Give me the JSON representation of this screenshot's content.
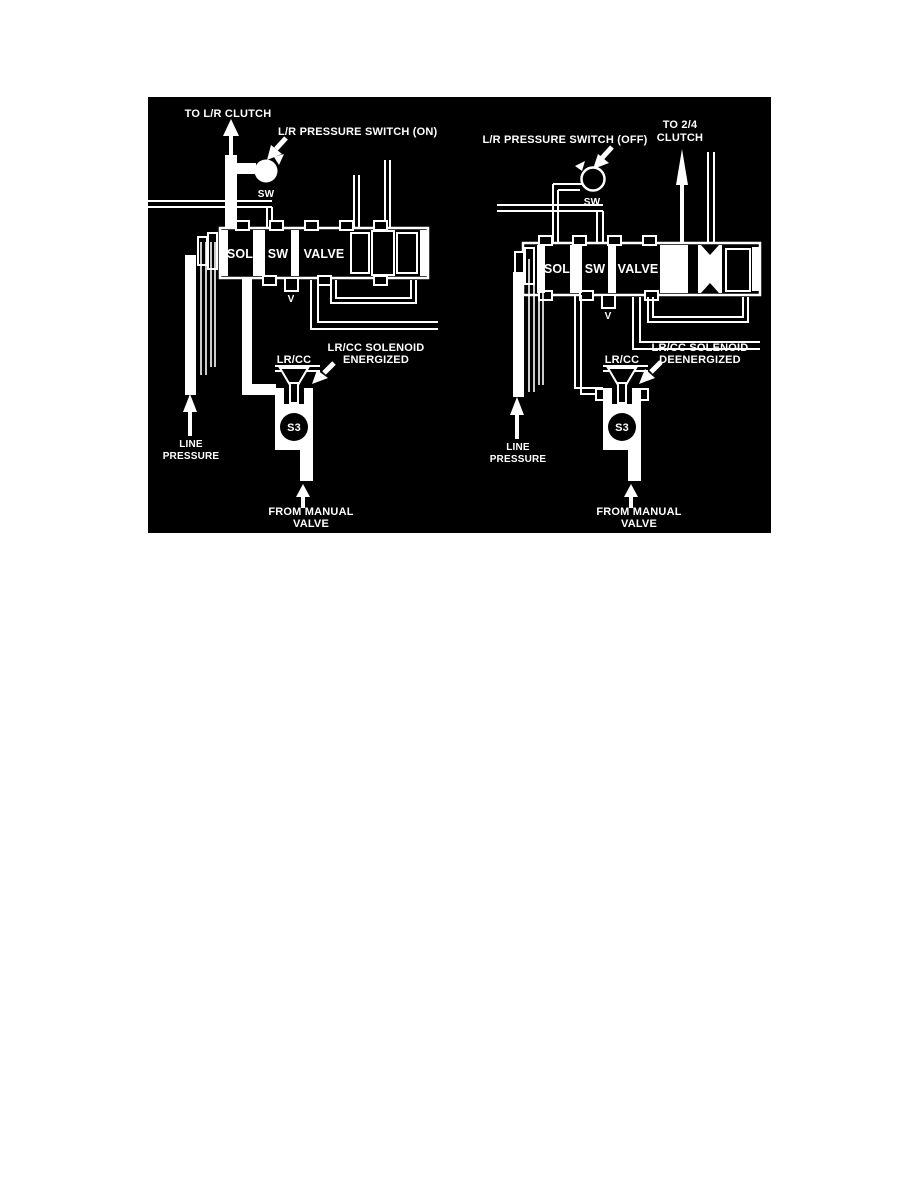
{
  "colors": {
    "page_background": "#ffffff",
    "diagram_background": "#000000",
    "diagram_foreground": "#ffffff"
  },
  "diagram": {
    "left": {
      "to_clutch": "TO L/R CLUTCH",
      "pressure_switch": "L/R PRESSURE SWITCH (ON)",
      "switch_tag": "SW",
      "valve": {
        "sol": "SOL",
        "sw": "SW",
        "valve": "VALVE",
        "vent": "V"
      },
      "line_pressure": [
        "LINE",
        "PRESSURE"
      ],
      "solenoid_tag": "LR/CC",
      "solenoid_state": [
        "LR/CC SOLENOID",
        "ENERGIZED"
      ],
      "solenoid_id": "S3",
      "from_manual": [
        "FROM MANUAL",
        "VALVE"
      ]
    },
    "right": {
      "to_clutch": [
        "TO 2/4",
        "CLUTCH"
      ],
      "pressure_switch": "L/R PRESSURE SWITCH (OFF)",
      "switch_tag": "SW",
      "valve": {
        "sol": "SOL",
        "sw": "SW",
        "valve": "VALVE",
        "vent": "V"
      },
      "line_pressure": [
        "LINE",
        "PRESSURE"
      ],
      "solenoid_tag": "LR/CC",
      "solenoid_state": [
        "LR/CC SOLENOID",
        "DEENERGIZED"
      ],
      "solenoid_id": "S3",
      "from_manual": [
        "FROM MANUAL",
        "VALVE"
      ]
    }
  }
}
